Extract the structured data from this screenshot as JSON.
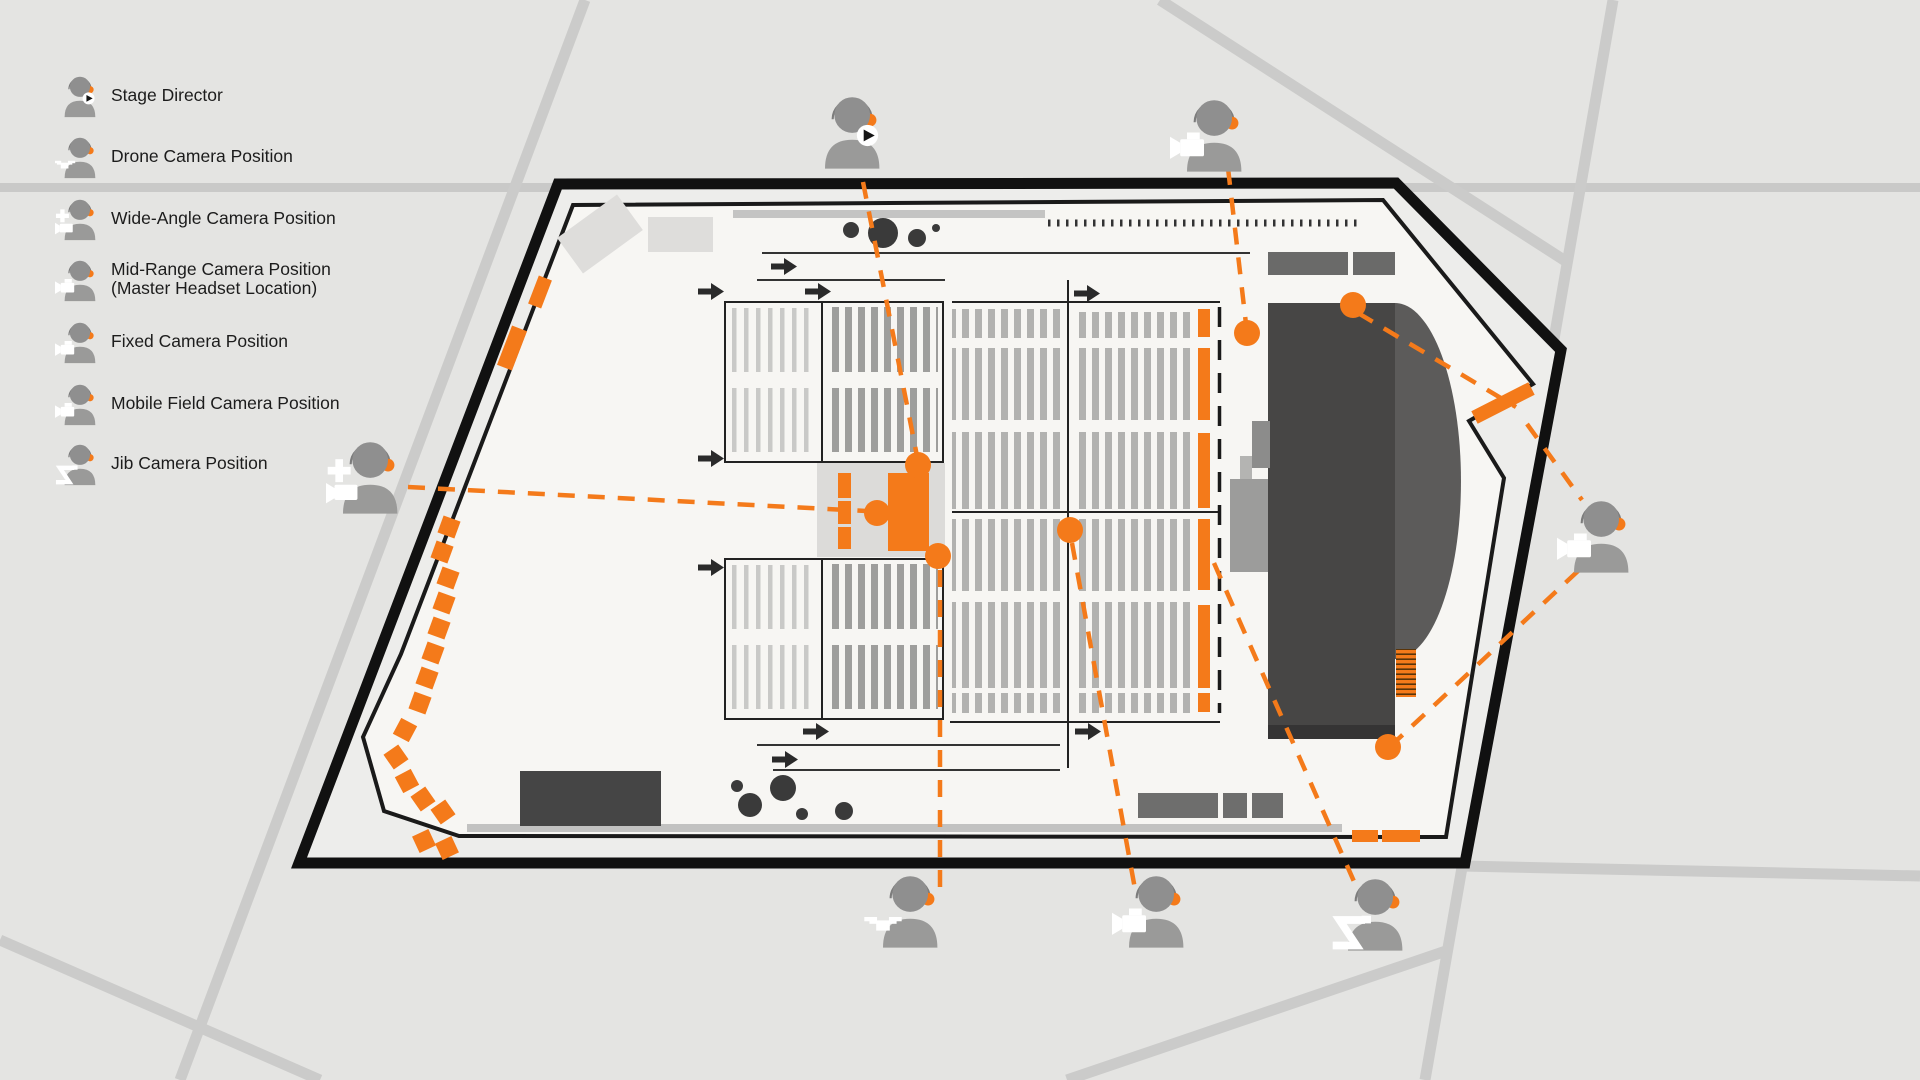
{
  "legend": {
    "items": [
      {
        "label": "Stage Director",
        "type": "stage-director"
      },
      {
        "label": "Drone Camera Position",
        "type": "drone"
      },
      {
        "label": "Wide-Angle Camera Position",
        "type": "wide-angle"
      },
      {
        "label": "Mid-Range Camera Position",
        "sublabel": "(Master Headset Location)",
        "type": "mid-range"
      },
      {
        "label": "Fixed Camera Position",
        "type": "fixed"
      },
      {
        "label": "Mobile Field Camera Position",
        "type": "mobile-field"
      },
      {
        "label": "Jib Camera Position",
        "type": "jib"
      }
    ]
  },
  "map": {
    "markers": [
      {
        "id": "stage-director-top-center",
        "icon": "headset-person-play-badge"
      },
      {
        "id": "camera-operator-top-right",
        "icon": "headset-person-camera"
      },
      {
        "id": "wide-angle-operator-left",
        "icon": "headset-person-camera-plus"
      },
      {
        "id": "drone-operator-bottom",
        "icon": "headset-person-drone"
      },
      {
        "id": "camera-operator-bottom",
        "icon": "headset-person-camera"
      },
      {
        "id": "jib-operator-bottom-right",
        "icon": "headset-person-jib"
      },
      {
        "id": "camera-operator-right",
        "icon": "headset-person-camera"
      }
    ],
    "camera_nodes": 7,
    "link_style": "orange-dashed"
  },
  "colors": {
    "accent_orange": "#F47A1A",
    "wall_black": "#111111",
    "floor": "#f7f6f3",
    "background": "#e4e4e2",
    "road": "#cbcbca",
    "stage_dark": "#474645",
    "person_gray": "#8f8f8f"
  }
}
